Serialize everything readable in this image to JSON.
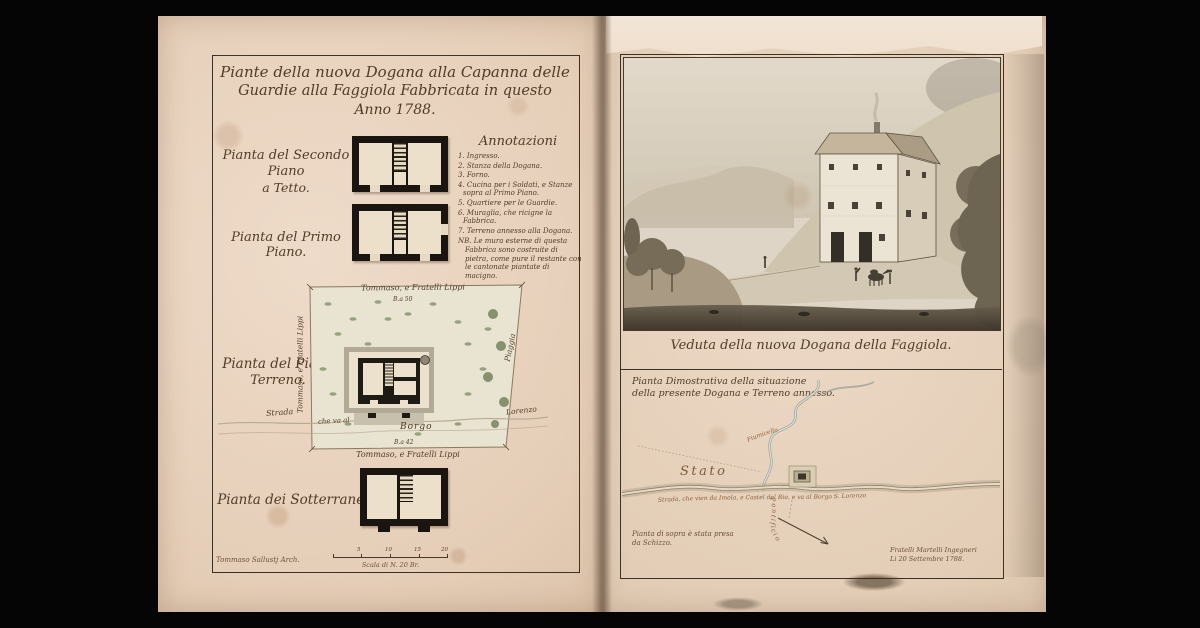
{
  "palette": {
    "mat": "#050505",
    "paper": "#e7d2bf",
    "frame_ink": "#2c2217",
    "handwriting_ink": "#503c27",
    "map_ink": "#8a5f3a",
    "wash_green": "#7c8c64",
    "veduta_wash": "#cfc4ae"
  },
  "doc": {
    "left": {
      "title": [
        "Piante della nuova Dogana alla Capanna delle",
        "Guardie alla Faggiola Fabbricata in questo",
        "Anno 1788."
      ],
      "plan_labels": {
        "secondo": [
          "Pianta del Secondo Piano",
          "a Tetto."
        ],
        "primo": "Pianta del Primo Piano.",
        "terreno": [
          "Pianta del Piano",
          "Terreno."
        ],
        "sotterranei": "Pianta dei Sotterranei."
      },
      "annotazioni": {
        "heading": "Annotazioni",
        "items": [
          "1. Ingresso.",
          "2. Stanza della Dogana.",
          "3. Forno.",
          "4. Cucina per i Soldati, e Stanze sopra al Primo Piano.",
          "5. Quartiere per le Guardie.",
          "6. Muraglia, che ricigne la Fabbrica.",
          "7. Terreno annesso alla Dogana.",
          "NB. Le mura esterne di questa Fabbrica sono costruite di pietra, come pure il restante con le cantonate piantate di macigno."
        ]
      },
      "site": {
        "owner_top": "Tommaso, e Fratelli Lippi",
        "owner_left": "Tommaso, e Fratelli Lippi",
        "owner_bottom": "Tommaso, e Fratelli Lippi",
        "right_label": "Piaggia",
        "measure_top": "B.a 50",
        "measure_bottom": "B.a 42",
        "strada": "Strada",
        "che_va_al": "che va al",
        "borgo": "Borgo",
        "lorenzo": "Lorenzo"
      },
      "footer": {
        "signature": "Tommaso Sallustj Arch.",
        "scale": "Scala di N. 20 Br.",
        "scale_ticks": [
          "5",
          "10",
          "15",
          "20"
        ]
      }
    },
    "right": {
      "veduta_caption": "Veduta della nuova Dogana della Faggiola.",
      "map": {
        "title": [
          "Pianta Dimostrativa della situazione",
          "della presente Dogana e Terreno annesso."
        ],
        "stato": "Stato",
        "pontificio": "Pontificio",
        "stream": "Fiumicello",
        "road": "Strada, che vien da Imola, e Castel del Rio, e va al Borgo S. Lorenzo",
        "note": [
          "Pianta di sopra è stata presa",
          "da Schizzo."
        ],
        "signature": [
          "Fratelli Martelli Ingegneri",
          "Li 20 Settembre 1788."
        ]
      }
    }
  }
}
